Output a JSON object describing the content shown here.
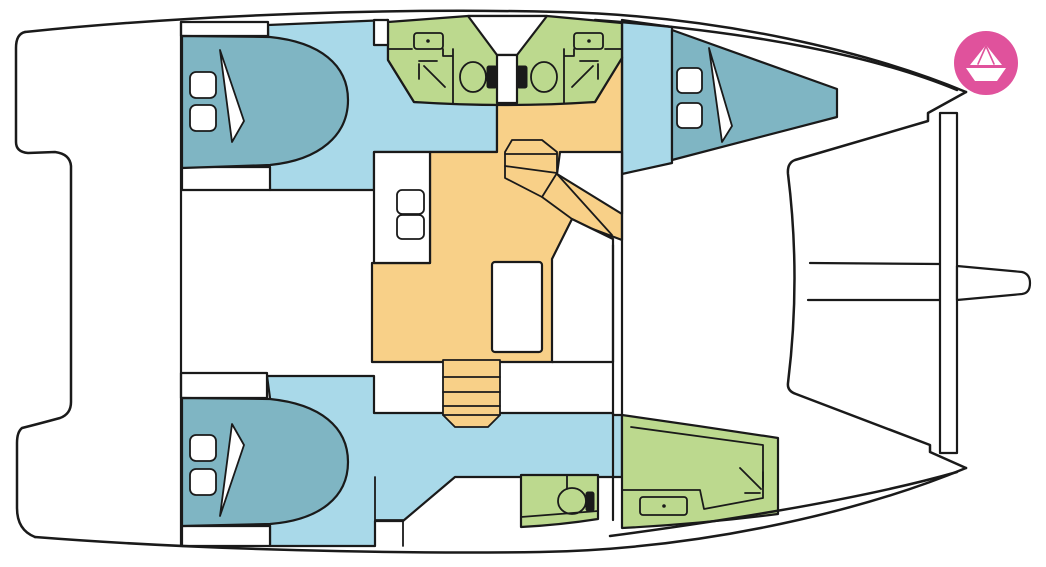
{
  "palette": {
    "line": "#1a1a1a",
    "floor_blue": "#a9d9e9",
    "bed_teal": "#7fb5c3",
    "bathroom_green": "#bcd98e",
    "salon_orange": "#f8d088",
    "white": "#ffffff",
    "logo_pink": "#e0529c",
    "logo_glyph": "#ffffff"
  },
  "diagram": {
    "type": "boat-floor-plan",
    "vessel": "catamaran",
    "regions": [
      "stern-platform",
      "cockpit",
      "aft-port-cabin",
      "forward-port-cabin",
      "port-bathrooms",
      "salon-galley",
      "starboard-corridor",
      "aft-starboard-cabin",
      "aft-starboard-bathroom",
      "forward-starboard-bathroom",
      "trampoline",
      "crossbeam",
      "bowsprit"
    ],
    "features": {
      "double_beds": 3,
      "pillows": 6,
      "toilets": 3,
      "washbasins": 4,
      "showers": 3,
      "staircases": 2,
      "salon_table": 1,
      "galley_sinks": 2
    }
  },
  "logo": {
    "shape": "paper-boat-in-circle"
  }
}
